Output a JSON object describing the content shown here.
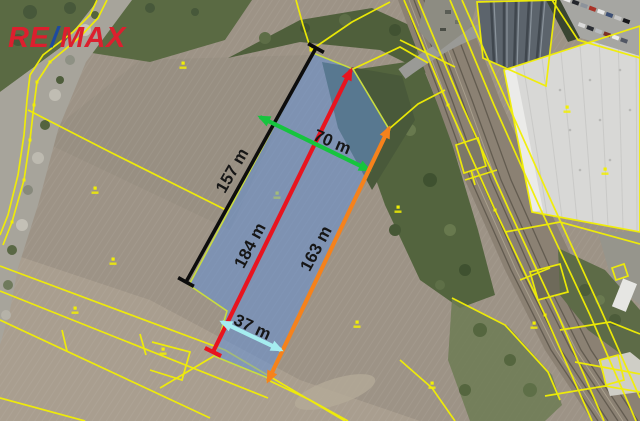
{
  "logo": {
    "text_re": "RE",
    "text_slash": "/",
    "text_max": "MAX",
    "color_red": "#dc1f2e",
    "color_blue": "#1e4a9e"
  },
  "map": {
    "cadastral_color": "#f2ef04",
    "parcel": {
      "fill": "rgba(100,145,215,0.55)",
      "stroke": "#c9dc40",
      "points": "313,53 353,69 389,129 268,378 214,356 227,311 189,285"
    },
    "measurements": [
      {
        "id": "left-side",
        "label": "157 m",
        "color": "#0d0d0d",
        "width": 3.6,
        "x1": 316,
        "y1": 48,
        "x2": 186,
        "y2": 282,
        "end1": "tick",
        "end2": "tick",
        "label_x": 233,
        "label_y": 171,
        "label_rot": -60
      },
      {
        "id": "middle-length",
        "label": "184 m",
        "color": "#e8141f",
        "width": 4.2,
        "x1": 351,
        "y1": 70,
        "x2": 213,
        "y2": 352,
        "end1": "arrow",
        "end2": "tick",
        "label_x": 251,
        "label_y": 246,
        "label_rot": -62
      },
      {
        "id": "top-width",
        "label": "70 m",
        "color": "#16c43e",
        "width": 4.2,
        "x1": 260,
        "y1": 117,
        "x2": 369,
        "y2": 170,
        "end1": "arrow",
        "end2": "arrow",
        "label_x": 332,
        "label_y": 143,
        "label_rot": 23
      },
      {
        "id": "right-side",
        "label": "163 m",
        "color": "#f5821c",
        "width": 4.2,
        "x1": 389,
        "y1": 128,
        "x2": 268,
        "y2": 381,
        "end1": "arrow",
        "end2": "arrow",
        "label_x": 317,
        "label_y": 249,
        "label_rot": -62
      },
      {
        "id": "bottom-width",
        "label": "37 m",
        "color": "#a5edf0",
        "width": 4.2,
        "x1": 222,
        "y1": 322,
        "x2": 281,
        "y2": 350,
        "end1": "arrow",
        "end2": "arrow",
        "label_x": 252,
        "label_y": 328,
        "label_rot": 25
      }
    ],
    "cadastral_lines": [
      {
        "points": "97,0 90,15 73,32 43,55 30,75 27,100 24,135 18,175 8,215 0,235"
      },
      {
        "points": "107,0 98,18 80,37 50,62 37,82 34,105 30,140 24,180 12,222 3,245"
      },
      {
        "points": "28,110 110,152 228,211"
      },
      {
        "points": "0,266 225,350 345,421"
      },
      {
        "points": "0,291 268,398"
      },
      {
        "points": "0,320 210,418"
      },
      {
        "points": "0,398 85,421"
      },
      {
        "points": "140,334 146,355"
      },
      {
        "points": "62,330 67,351"
      },
      {
        "points": "296,0 303,25 311,50"
      },
      {
        "points": "311,50 352,22 390,2"
      },
      {
        "points": "353,69 400,47 428,63"
      },
      {
        "points": "389,129 418,104 445,90"
      },
      {
        "points": "404,0 448,105 495,210 545,315 592,421"
      },
      {
        "points": "418,0 462,105 509,210 558,315 604,421"
      },
      {
        "points": "450,0 494,105 541,210 590,315 636,421"
      },
      {
        "points": "462,0 506,100 553,205 601,310 640,398"
      },
      {
        "points": "400,40 455,67"
      },
      {
        "points": "465,180 497,170"
      },
      {
        "points": "520,280 550,268"
      },
      {
        "points": "504,70 640,26 640,232 532,212",
        "closed": true
      },
      {
        "points": "477,2 556,0 546,86 483,58",
        "closed": true
      },
      {
        "points": "552,0 578,40 640,58"
      },
      {
        "points": "456,145 478,138 486,166 464,173",
        "closed": true
      },
      {
        "points": "471,170 475,185"
      },
      {
        "points": "612,268 624,264 628,276 616,280",
        "closed": true
      },
      {
        "points": "600,360 618,355 624,380 606,385",
        "closed": true
      },
      {
        "points": "530,272 560,264 568,292 538,300",
        "closed": true
      },
      {
        "points": "505,232 560,222 640,244"
      },
      {
        "points": "560,330 610,322 640,334"
      },
      {
        "points": "575,362 640,374"
      },
      {
        "points": "545,396 605,386 640,392"
      },
      {
        "points": "268,380 310,400 348,421"
      },
      {
        "points": "400,360 432,388 455,421"
      },
      {
        "points": "452,298 505,325 548,372 560,400"
      },
      {
        "points": "214,356 160,388"
      },
      {
        "points": "152,342 190,352 182,380 150,370"
      }
    ],
    "vertex_points": [
      [
        37,
        82
      ],
      [
        34,
        105
      ],
      [
        30,
        140
      ],
      [
        24,
        180
      ],
      [
        50,
        62
      ],
      [
        12,
        222
      ],
      [
        311,
        50
      ],
      [
        389,
        129
      ],
      [
        268,
        380
      ],
      [
        448,
        105
      ],
      [
        495,
        210
      ],
      [
        545,
        315
      ]
    ],
    "parcel_markers": [
      [
        183,
        66
      ],
      [
        95,
        191
      ],
      [
        277,
        196
      ],
      [
        113,
        262
      ],
      [
        75,
        311
      ],
      [
        163,
        352
      ],
      [
        357,
        325
      ],
      [
        398,
        210
      ],
      [
        534,
        326
      ],
      [
        432,
        386
      ],
      [
        605,
        172
      ],
      [
        567,
        110
      ]
    ]
  }
}
